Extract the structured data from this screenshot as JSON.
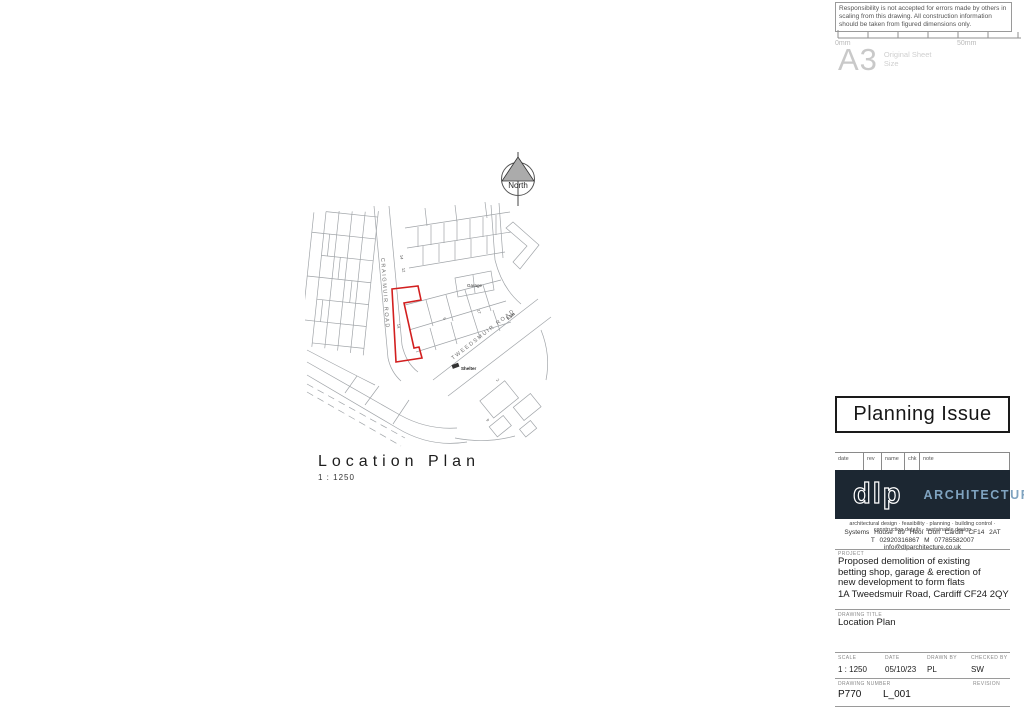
{
  "disclaimer": {
    "text": "Responsibility is not accepted for errors made by others in scaling from this drawing.  All construction information should be taken from figured dimensions only."
  },
  "ruler": {
    "start_label": "0mm",
    "end_label": "50mm"
  },
  "sheet": {
    "size": "A3",
    "size_label": "Original Sheet Size"
  },
  "north_arrow": {
    "label": "North"
  },
  "map": {
    "road_1": "CRAIGMUIR ROAD",
    "road_2": "TWEEDSMUIR ROAD",
    "garage_label": "Garage",
    "shelter_label": "Shelter",
    "height_note": "5.5m",
    "site_label": "1a",
    "plot_numbers": [
      "14",
      "12",
      "17",
      "6",
      "2",
      "9"
    ],
    "site_outline_color": "#d21f1f"
  },
  "plan_caption": {
    "title": "Location Plan",
    "scale": "1 : 1250"
  },
  "status_box": {
    "label": "Planning Issue"
  },
  "revision_table": {
    "headers": [
      "date",
      "rev",
      "name",
      "chk",
      "note"
    ]
  },
  "firm": {
    "logo_text": "dlp",
    "logo_name": "ARCHITECTURE",
    "tagline": "architectural design · feasibility · planning · building control · construction details · sustainable design",
    "address": "Systems House  89 Heol Don  Cardiff  CF14 2AT",
    "contact": "T 02920316867  M 07785582007  info@dlparchitecture.co.uk",
    "logo_bg_color": "#1c2732",
    "logo_accent_color": "#7fa3c0"
  },
  "title_block": {
    "project_label": "PROJECT",
    "project": "Proposed demolition of existing betting shop, garage & erection of new development to form flats",
    "site_address": "1A Tweedsmuir Road, Cardiff CF24 2QY",
    "drawing_title_label": "DRAWING TITLE",
    "drawing_title": "Location Plan",
    "scale_label": "SCALE",
    "scale": "1 : 1250",
    "date_label": "DATE",
    "date": "05/10/23",
    "drawn_label": "DRAWN BY",
    "drawn_by": "PL",
    "checked_label": "CHECKED BY",
    "checked_by": "SW",
    "number_label": "DRAWING NUMBER",
    "drawing_number": "P770",
    "sheet_code": "L_001",
    "revision_label": "REVISION",
    "revision": ""
  }
}
